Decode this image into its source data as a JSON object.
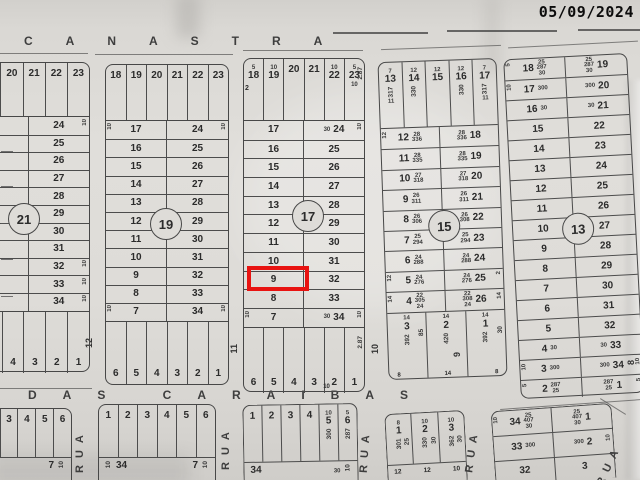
{
  "date_stamp": "05/09/2024",
  "streets": {
    "top": "CANASTRA",
    "bottom": "DAS CARAIBAS",
    "cross_street_label": "RUA",
    "cross_street_numbers": {
      "n12": "12",
      "n11": "11",
      "n10": "10",
      "n9": "9",
      "n8": "8"
    }
  },
  "highlight": {
    "block": "17",
    "lot": "9",
    "color": "#e81311"
  },
  "blocks": {
    "b21": {
      "id": "21",
      "top": [
        {},
        {},
        {
          "n": "20"
        },
        {
          "n": "21"
        },
        {
          "n": "22"
        },
        {
          "n": "23"
        }
      ],
      "rows": [
        {
          "r": "24",
          "rm": "10"
        },
        {
          "r": "25"
        },
        {
          "r": "26"
        },
        {
          "r": "27"
        },
        {
          "r": "28"
        },
        {
          "r": "29"
        },
        {
          "r": "30"
        },
        {
          "r": "31"
        },
        {
          "r": "32",
          "rm": "10"
        },
        {
          "r": "33",
          "rm": "10"
        },
        {
          "r": "34",
          "rm": "10"
        }
      ],
      "bottom": [
        {},
        {},
        {
          "n": "4"
        },
        {
          "n": "3"
        },
        {
          "n": "2"
        },
        {
          "n": "1"
        }
      ]
    },
    "b19": {
      "id": "19",
      "top": [
        {
          "n": "18"
        },
        {
          "n": "19"
        },
        {
          "n": "20"
        },
        {
          "n": "21"
        },
        {
          "n": "22"
        },
        {
          "n": "23"
        }
      ],
      "rows": [
        {
          "l": "17",
          "lm": "10",
          "r": "24",
          "rm": "10"
        },
        {
          "l": "16",
          "r": "25"
        },
        {
          "l": "15",
          "r": "26"
        },
        {
          "l": "14",
          "r": "27"
        },
        {
          "l": "13",
          "r": "28"
        },
        {
          "l": "12",
          "r": "29"
        },
        {
          "l": "11",
          "r": "30"
        },
        {
          "l": "10",
          "r": "31"
        },
        {
          "l": "9",
          "r": "32"
        },
        {
          "l": "8",
          "r": "33"
        },
        {
          "l": "7",
          "lm": "10",
          "r": "34",
          "rm": "10"
        }
      ],
      "bottom": [
        {
          "n": "6"
        },
        {
          "n": "5"
        },
        {
          "n": "4"
        },
        {
          "n": "3"
        },
        {
          "n": "2"
        },
        {
          "n": "1"
        }
      ]
    },
    "b17": {
      "id": "17",
      "strip_note": "2",
      "bottom_note": "10",
      "top": [
        {
          "n": "18",
          "s": "5"
        },
        {
          "n": "19",
          "s": "10"
        },
        {
          "n": "20"
        },
        {
          "n": "21"
        },
        {
          "n": "22",
          "s": "10"
        },
        {
          "n": "23",
          "s": "5",
          "e": "2.87",
          "b": "10"
        }
      ],
      "rows": [
        {
          "l": "17",
          "r": "24",
          "rd": "30",
          "rm": "10"
        },
        {
          "l": "16",
          "r": "25"
        },
        {
          "l": "15",
          "r": "26"
        },
        {
          "l": "14",
          "r": "27"
        },
        {
          "l": "13",
          "r": "28"
        },
        {
          "l": "12",
          "r": "29"
        },
        {
          "l": "11",
          "r": "30"
        },
        {
          "l": "10",
          "r": "31"
        },
        {
          "l": "9",
          "r": "32"
        },
        {
          "l": "8",
          "r": "33"
        },
        {
          "l": "7",
          "lm": "10",
          "r": "34",
          "rd": "30",
          "rm": "10"
        }
      ],
      "bottom": [
        {
          "n": "6"
        },
        {
          "n": "5"
        },
        {
          "n": "4"
        },
        {
          "n": "3"
        },
        {
          "n": "2"
        },
        {
          "n": "1",
          "e": "2.87"
        }
      ]
    },
    "b15": {
      "id": "15",
      "top": [
        {
          "n": "13",
          "s": "7",
          "d": "317",
          "b": "11"
        },
        {
          "n": "14",
          "s": "12",
          "d": "330"
        },
        {
          "n": "15",
          "s": "12"
        },
        {
          "n": "16",
          "s": "12",
          "d": "330"
        },
        {
          "n": "17",
          "s": "7",
          "d": "317",
          "b": "11"
        }
      ],
      "rows": [
        {
          "l": "12",
          "ld": "28\n336",
          "rd": "28\n336",
          "r": "18",
          "lm": "12"
        },
        {
          "l": "11",
          "ld": "28\n335",
          "rd": "28\n335",
          "r": "19"
        },
        {
          "l": "10",
          "ld": "27\n318",
          "rd": "27\n318",
          "r": "20"
        },
        {
          "l": "9",
          "ld": "26\n311",
          "rd": "26\n311",
          "r": "21"
        },
        {
          "l": "8",
          "ld": "26\n306",
          "rd": "26\n308",
          "r": "22"
        },
        {
          "l": "7",
          "ld": "25\n294",
          "rd": "25\n294",
          "r": "23"
        },
        {
          "l": "6",
          "ld": "24\n288",
          "rd": "24\n288",
          "r": "24"
        },
        {
          "l": "5",
          "ld": "24\n276",
          "rd": "24\n276",
          "r": "25",
          "lm": "12",
          "rm": "2"
        },
        {
          "l": "4",
          "ld": "22\n305\n24",
          "rd": "22\n308\n24",
          "r": "26",
          "lm": "14",
          "rm": "14"
        }
      ],
      "bottom": [
        {
          "n": "3",
          "s": "14",
          "d": "392",
          "e": "85"
        },
        {
          "n": "2",
          "s": "14",
          "d": "420"
        },
        {
          "n": "1",
          "s": "14",
          "d": "392",
          "e": "30"
        }
      ],
      "bnotes": {
        "a": "8",
        "b": "14",
        "c": "8"
      }
    },
    "b13": {
      "id": "13",
      "rows": [
        {
          "l": "18",
          "ld": "25\n287\n30",
          "rd": "25\n287\n30",
          "r": "19",
          "lm": "5"
        },
        {
          "l": "17",
          "ld": "300",
          "rd": "300",
          "r": "20",
          "lm": "10"
        },
        {
          "l": "16",
          "ld": "30",
          "rd": "30",
          "r": "21"
        },
        {
          "l": "15",
          "r": "22"
        },
        {
          "l": "14",
          "r": "23"
        },
        {
          "l": "13",
          "r": "24"
        },
        {
          "l": "12",
          "r": "25"
        },
        {
          "l": "11",
          "r": "26"
        },
        {
          "l": "10",
          "r": "27"
        },
        {
          "l": "9",
          "r": "28"
        },
        {
          "l": "8",
          "r": "29"
        },
        {
          "l": "7",
          "r": "30"
        },
        {
          "l": "6",
          "r": "31"
        },
        {
          "l": "5",
          "r": "32"
        },
        {
          "l": "4",
          "ld": "30",
          "rd": "30",
          "r": "33"
        },
        {
          "l": "3",
          "ld": "300",
          "rd": "300",
          "r": "34",
          "lm": "10",
          "rm": "10"
        },
        {
          "l": "2",
          "ld": "287\n25",
          "rd": "287\n25",
          "r": "1",
          "lm": "5",
          "rm": "5"
        }
      ]
    },
    "ba": {
      "top": [
        {},
        {},
        {
          "n": "3"
        },
        {
          "n": "4"
        },
        {
          "n": "5"
        },
        {
          "n": "6"
        }
      ],
      "bottom_label": "7",
      "bottom_mark": "10"
    },
    "bb": {
      "top": [
        {
          "n": "1"
        },
        {
          "n": "2"
        },
        {
          "n": "3"
        },
        {
          "n": "4"
        },
        {
          "n": "5"
        },
        {
          "n": "6"
        }
      ],
      "mark_left": "10",
      "bottom_left": "34",
      "bottom_right": "7",
      "mark_right": "10"
    },
    "bc": {
      "top": [
        {
          "n": "1"
        },
        {
          "n": "2"
        },
        {
          "n": "3"
        },
        {
          "n": "4"
        },
        {
          "n": "5",
          "s": "10",
          "d": "300"
        },
        {
          "n": "6",
          "s": "5",
          "d": "287"
        }
      ],
      "bottom_left": "34",
      "bottom_mid": "30",
      "mark_right": "10"
    },
    "bd": {
      "top": [
        {
          "n": "1",
          "s": "8",
          "d": "301",
          "e": "25"
        },
        {
          "n": "2",
          "s": "10",
          "d": "330",
          "e": "30"
        },
        {
          "n": "3",
          "s": "10",
          "d": "362",
          "e": "30"
        }
      ],
      "bnotes": {
        "a": "12",
        "b": "12",
        "c": "10"
      }
    },
    "be": {
      "rows": [
        {
          "l": "34",
          "ld": "25\n407\n30",
          "rd": "25\n407\n30",
          "r": "1",
          "lm": "10"
        },
        {
          "l": "33",
          "ld": "300",
          "rd": "300",
          "r": "2",
          "rm": "10"
        },
        {
          "l": "32",
          "r": "3"
        }
      ]
    }
  }
}
